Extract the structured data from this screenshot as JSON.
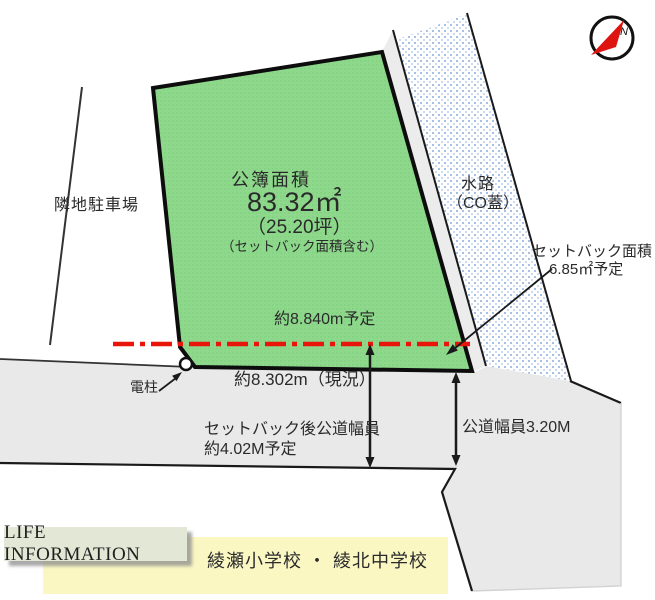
{
  "colors": {
    "parcel_green": "#8ed88c",
    "road_gray": "#e9e9e9",
    "gap_gray": "#ececec",
    "waterway_dot_blue": "#a8c0e4",
    "setback_line_red": "#e8150a",
    "banner_yellow": "#faf7c3",
    "life_box_sage": "#e3e7d5",
    "compass_needle_red": "#dd1410"
  },
  "parcel": {
    "title": "公簿面積",
    "area": "83.32㎡",
    "area_tsubo": "（25.20坪）",
    "note": "（セットバック面積含む）",
    "frontage_planned": "約8.840m予定"
  },
  "surroundings": {
    "parking": "隣地駐車場",
    "waterway_line1": "水路",
    "waterway_line2": "（CO蓋）",
    "pole": "電柱"
  },
  "setback": {
    "label_line1": "セットバック面積",
    "label_line2": "6.85㎡予定"
  },
  "road": {
    "frontage_current": "約8.302m（現況）",
    "after_setback_line1": "セットバック後公道幅員",
    "after_setback_line2": "約4.02M予定",
    "width": "公道幅員3.20M"
  },
  "compass": {
    "north": "N"
  },
  "footer": {
    "life_info": "LIFE INFORMATION",
    "schools": "綾瀬小学校 ・ 綾北中学校"
  }
}
